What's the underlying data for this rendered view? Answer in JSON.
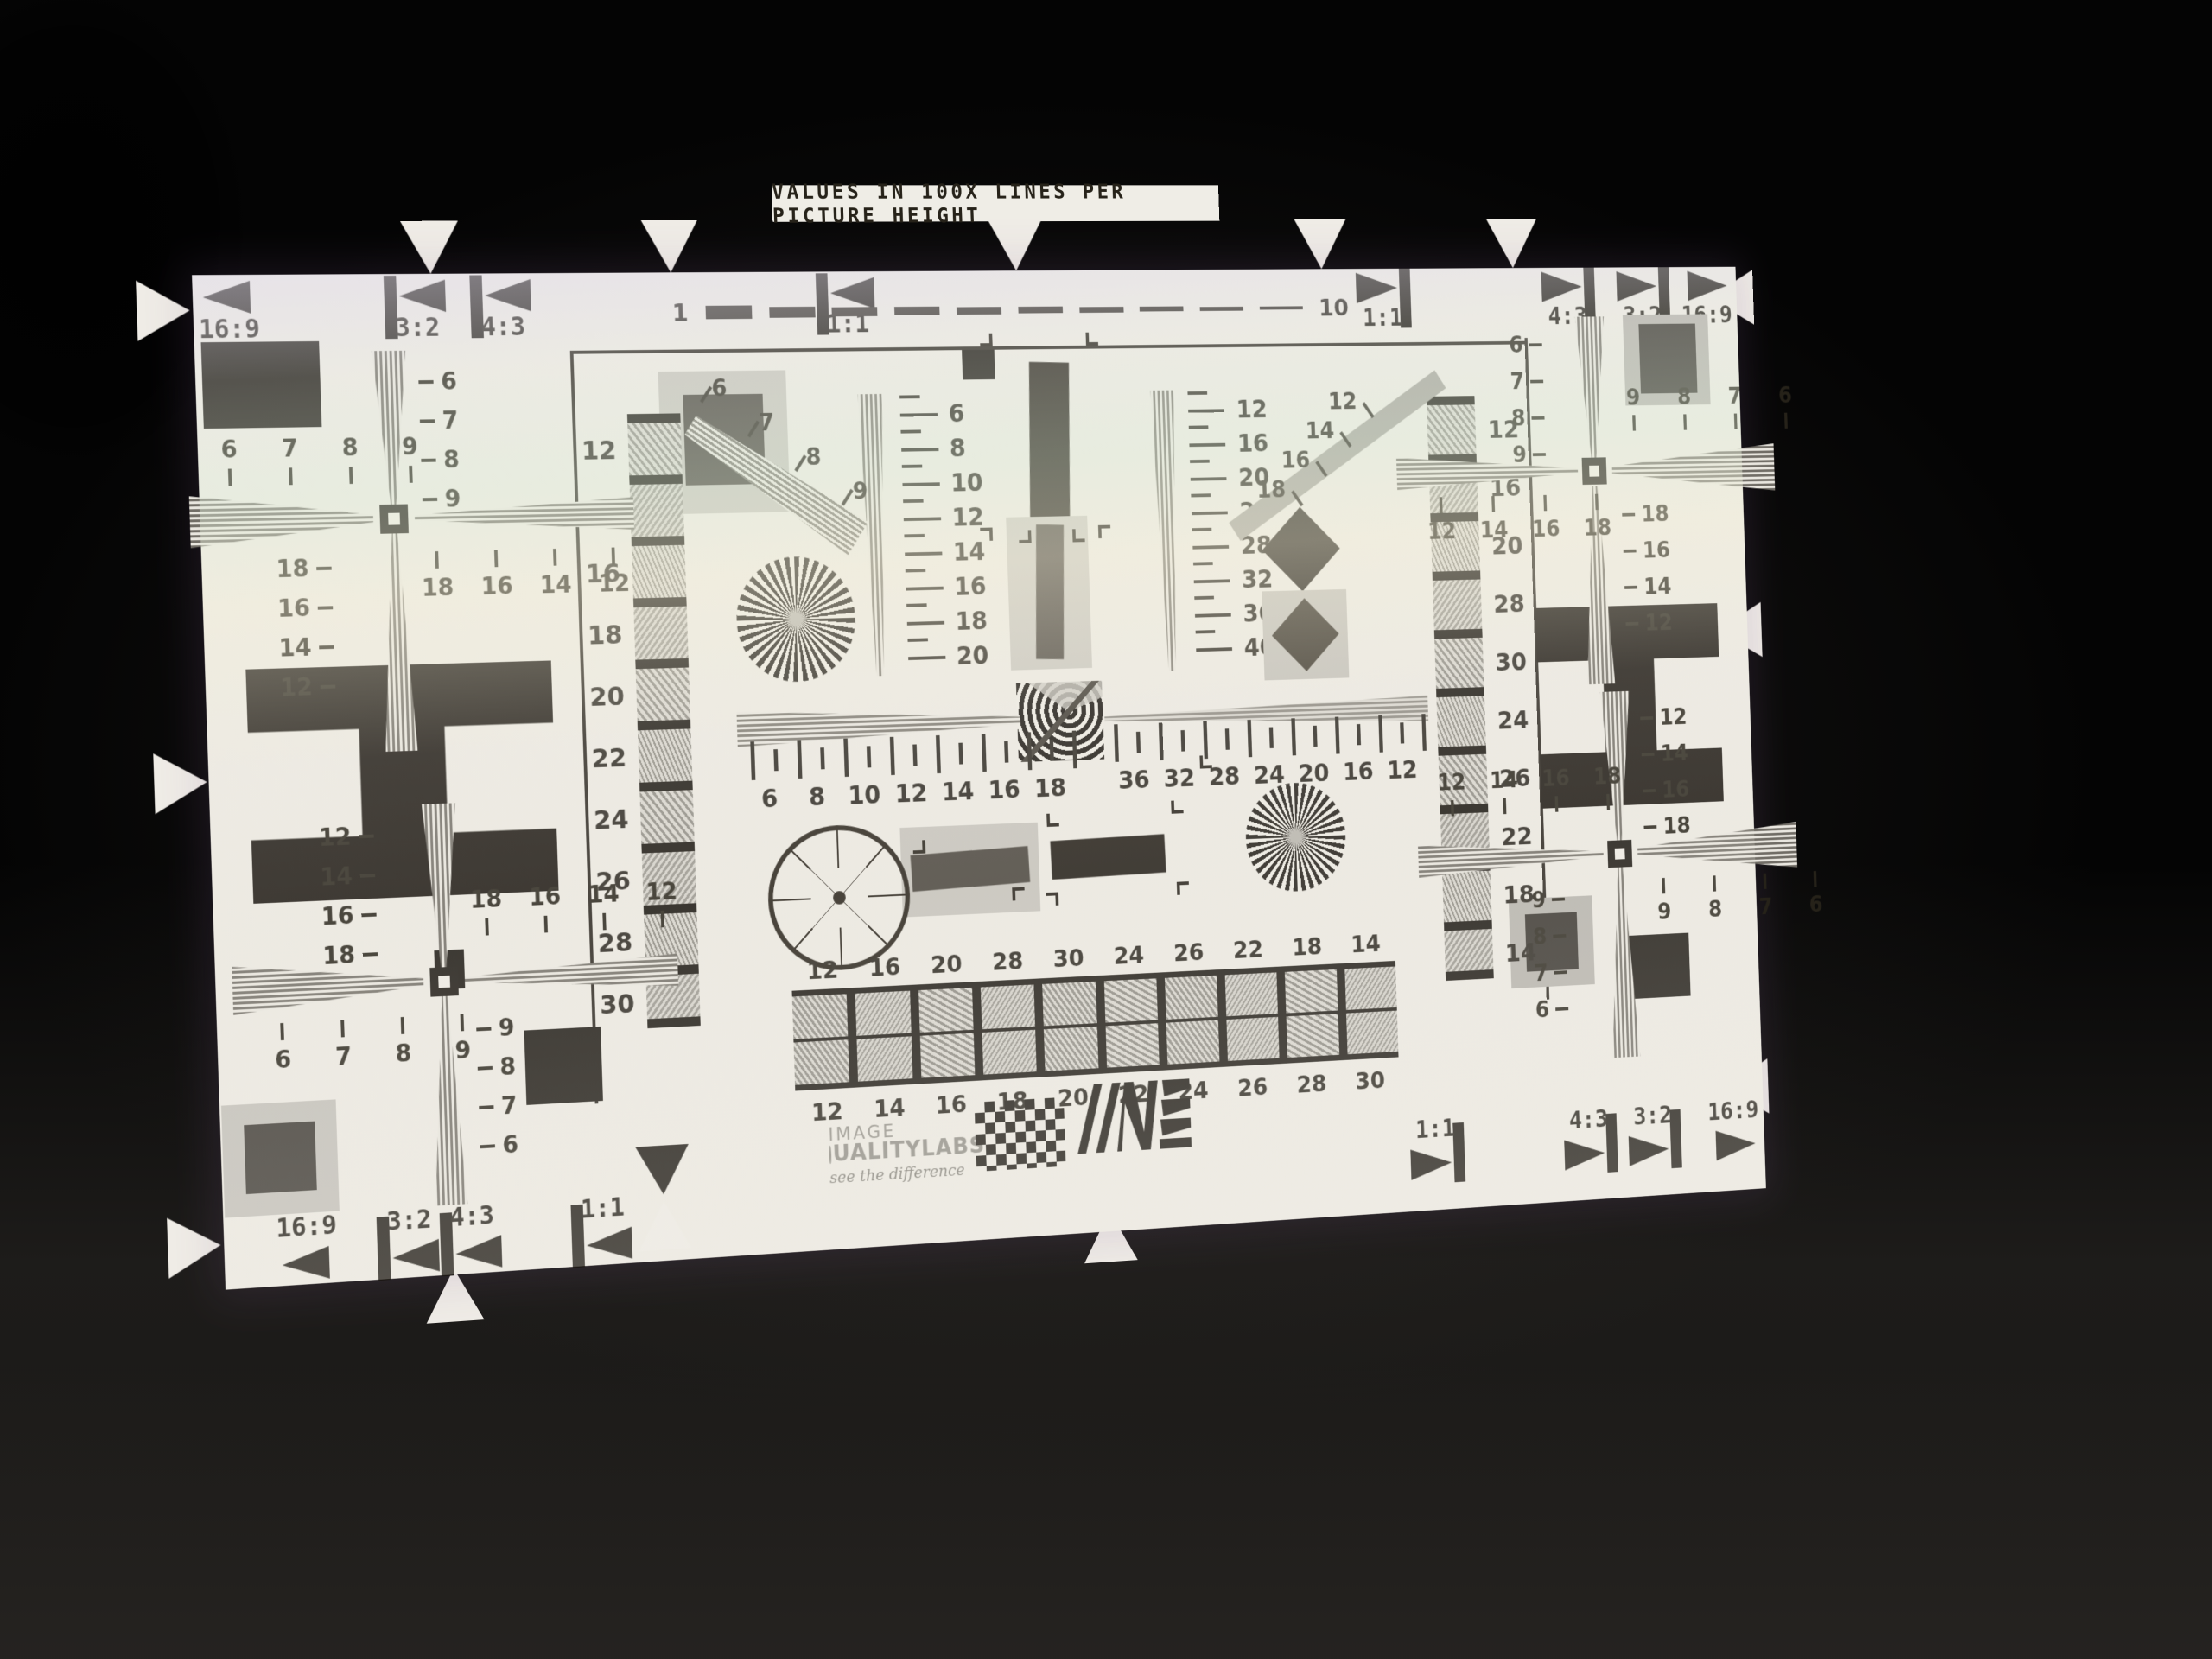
{
  "scene": {
    "title": "VALUES IN 100X LINES PER PICTURE HEIGHT",
    "brand": {
      "line1": "IMAGE",
      "line2": "UALITYLABS",
      "tagline": "see the difference"
    },
    "colors": {
      "chart_bg": "#edeae3",
      "ink": "#17130e",
      "mid_gray": "#8e8b84",
      "frame_gray": "#c6c3bc"
    }
  },
  "markers": {
    "top_left": [
      "16:9",
      "3:2",
      "4:3",
      "1:1"
    ],
    "top_right": [
      "1:1",
      "4:3",
      "3:2",
      "16:9"
    ],
    "bottom_left": [
      "16:9",
      "3:2",
      "4:3",
      "1:1"
    ],
    "bottom_right": [
      "1:1",
      "4:3",
      "3:2",
      "16:9"
    ]
  },
  "dash_scale": {
    "start": "1",
    "end": "10"
  },
  "strips": {
    "left": [
      "12",
      "14",
      "16",
      "18",
      "20",
      "22",
      "24",
      "26",
      "28",
      "30"
    ],
    "right": [
      "12",
      "16",
      "20",
      "28",
      "30",
      "24",
      "26",
      "22",
      "18",
      "14"
    ]
  },
  "checkerboard": {
    "top": [
      "12",
      "16",
      "20",
      "28",
      "30",
      "24",
      "26",
      "22",
      "18",
      "14"
    ],
    "bottom": [
      "12",
      "14",
      "16",
      "18",
      "20",
      "22",
      "24",
      "26",
      "28",
      "30"
    ]
  },
  "vscales": {
    "left": [
      "6",
      "8",
      "10",
      "12",
      "14",
      "16",
      "18",
      "20"
    ],
    "right": [
      "12",
      "16",
      "20",
      "24",
      "28",
      "32",
      "36",
      "40"
    ]
  },
  "hruler": {
    "left": [
      "6",
      "8",
      "10",
      "12",
      "14",
      "16",
      "18"
    ],
    "right": [
      "36",
      "32",
      "28",
      "24",
      "20",
      "16",
      "12"
    ]
  },
  "diagonals": {
    "fan": [
      "6",
      "7",
      "8",
      "9"
    ],
    "bar": [
      "12",
      "14",
      "16",
      "18"
    ]
  },
  "crosses": {
    "tl": {
      "up": [
        "6",
        "7",
        "8",
        "9"
      ],
      "outer": [
        "6",
        "7",
        "8",
        "9"
      ],
      "down": [
        "18",
        "16",
        "14",
        "12"
      ],
      "inner": [
        "18",
        "16",
        "14",
        "12"
      ]
    },
    "bl": {
      "up": [
        "12",
        "14",
        "16",
        "18"
      ],
      "inner": [
        "18",
        "16",
        "14",
        "12"
      ],
      "outer": [
        "6",
        "7",
        "8",
        "9"
      ],
      "down": [
        "9",
        "8",
        "7",
        "6"
      ]
    },
    "tr": {
      "up": [
        "6",
        "7",
        "8",
        "9"
      ],
      "outer": [
        "9",
        "8",
        "7",
        "6"
      ],
      "inner": [
        "12",
        "14",
        "16",
        "18"
      ],
      "down": [
        "18",
        "16",
        "14",
        "12"
      ]
    },
    "br": {
      "up": [
        "12",
        "14",
        "16",
        "18"
      ],
      "inner": [
        "12",
        "14",
        "16",
        "18"
      ],
      "outer": [
        "9",
        "8",
        "7",
        "6"
      ],
      "down": [
        "9",
        "8",
        "7",
        "6"
      ]
    }
  }
}
